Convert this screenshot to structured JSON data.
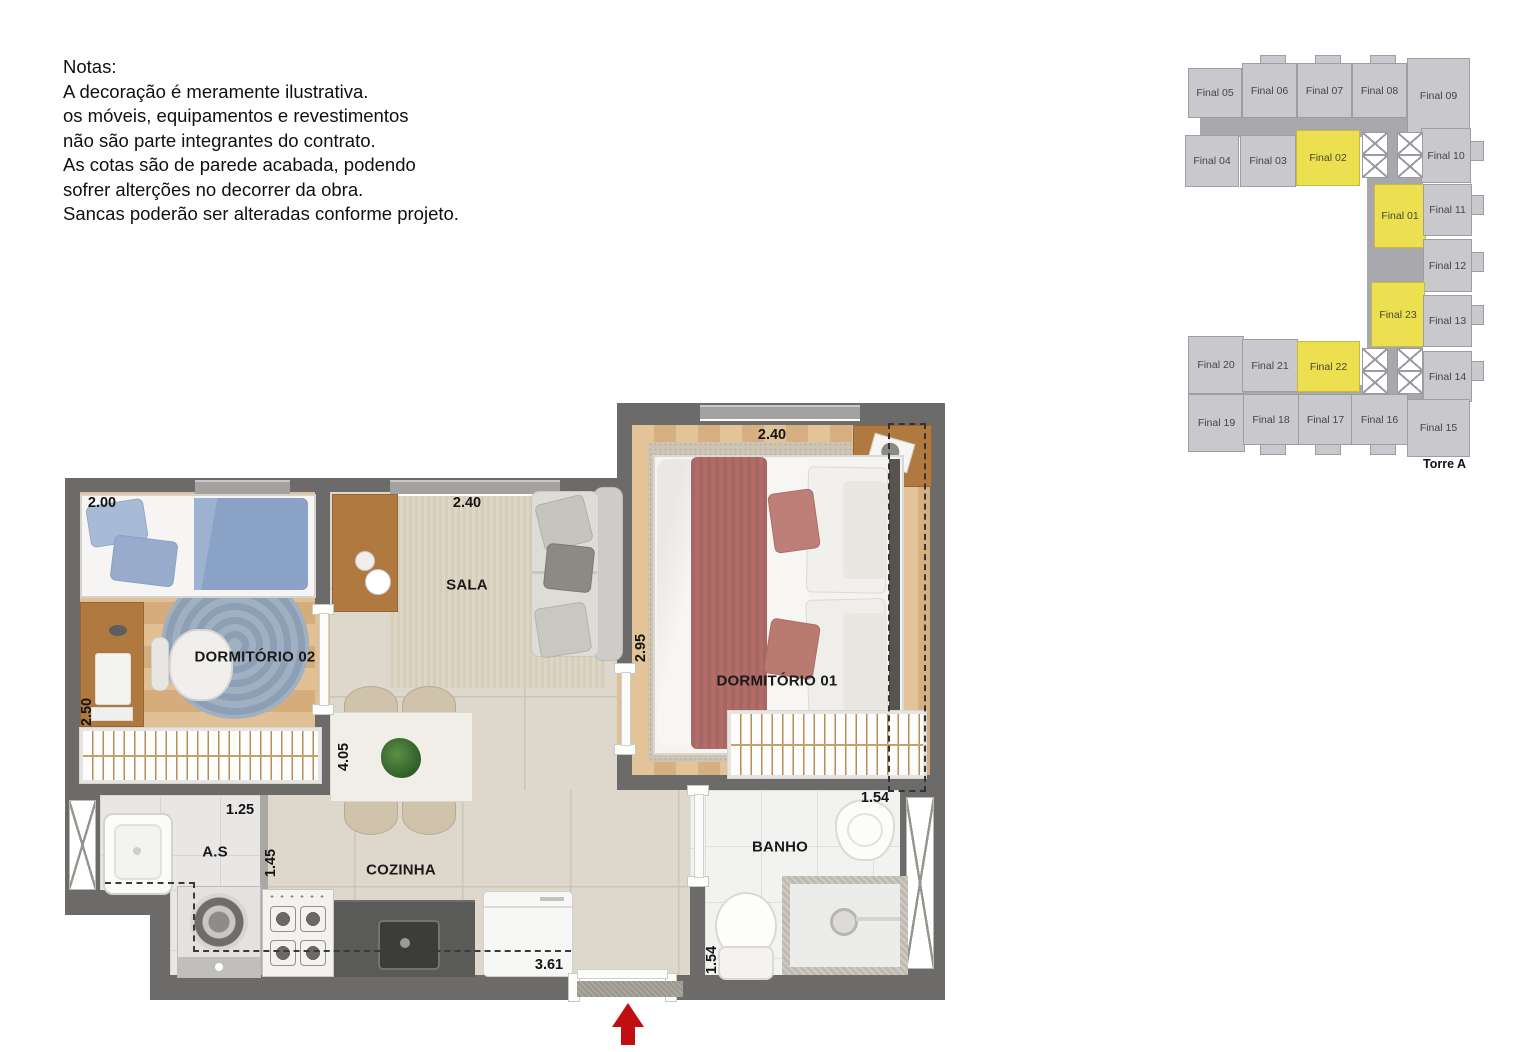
{
  "notes": {
    "title": "Notas:",
    "lines": [
      "A decoração é meramente ilustrativa.",
      "os móveis, equipamentos e revestimentos",
      "não são parte integrantes do contrato.",
      "As cotas são de parede acabada, podendo",
      "sofrer alterções no decorrer da obra.",
      "Sancas poderão ser alteradas conforme projeto."
    ]
  },
  "floorplan": {
    "rooms": {
      "dormitorio02": "DORMITÓRIO 02",
      "sala": "SALA",
      "dormitorio01": "DORMITÓRIO 01",
      "area_servico": "A.S",
      "cozinha": "COZINHA",
      "banho": "BANHO"
    },
    "dimensions": {
      "dorm02_width": "2.00",
      "dorm02_depth": "2.50",
      "sala_width": "2.40",
      "dorm01_width": "2.40",
      "dorm01_depth": "2.95",
      "cozinha_depth": "4.05",
      "as_width": "1.25",
      "as_depth": "1.45",
      "cozinha_width": "3.61",
      "banho_width": "1.54",
      "banho_depth": "1.54"
    },
    "entry_arrow_color": "#bf0f12"
  },
  "keyplan": {
    "torre_label": "Torre A",
    "unit_fill": "#c9c8cd",
    "highlight_fill": "#ece051",
    "units": [
      {
        "label": "Final 05",
        "highlighted": false
      },
      {
        "label": "Final 06",
        "highlighted": false
      },
      {
        "label": "Final 07",
        "highlighted": false
      },
      {
        "label": "Final 08",
        "highlighted": false
      },
      {
        "label": "Final 09",
        "highlighted": false
      },
      {
        "label": "Final 04",
        "highlighted": false
      },
      {
        "label": "Final 03",
        "highlighted": false
      },
      {
        "label": "Final 02",
        "highlighted": true
      },
      {
        "label": "Final 10",
        "highlighted": false
      },
      {
        "label": "Final 01",
        "highlighted": true
      },
      {
        "label": "Final 11",
        "highlighted": false
      },
      {
        "label": "Final 12",
        "highlighted": false
      },
      {
        "label": "Final 23",
        "highlighted": true
      },
      {
        "label": "Final 13",
        "highlighted": false
      },
      {
        "label": "Final 20",
        "highlighted": false
      },
      {
        "label": "Final 21",
        "highlighted": false
      },
      {
        "label": "Final 22",
        "highlighted": true
      },
      {
        "label": "Final 14",
        "highlighted": false
      },
      {
        "label": "Final 19",
        "highlighted": false
      },
      {
        "label": "Final 18",
        "highlighted": false
      },
      {
        "label": "Final 17",
        "highlighted": false
      },
      {
        "label": "Final 16",
        "highlighted": false
      },
      {
        "label": "Final 15",
        "highlighted": false
      }
    ]
  }
}
